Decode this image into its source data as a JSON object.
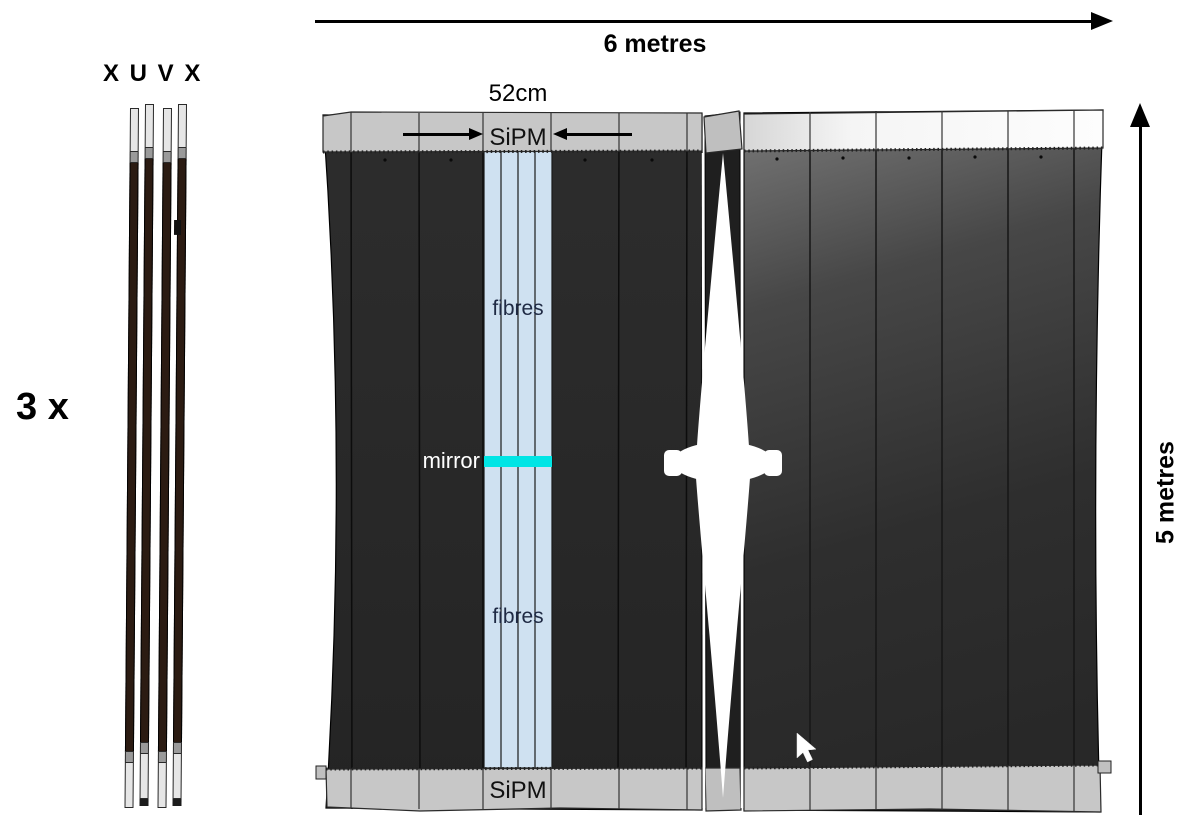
{
  "side_view": {
    "orientation_label": "X U V X",
    "count_label": "3 x"
  },
  "dimensions": {
    "width_label": "6 metres",
    "height_label": "5 metres",
    "module_width_label": "52cm"
  },
  "front_view": {
    "sipm_top_label": "SiPM",
    "sipm_bottom_label": "SiPM",
    "fibres_top_label": "fibres",
    "fibres_bottom_label": "fibres",
    "mirror_label": "mirror"
  },
  "colors": {
    "mirror_cyan": "#00e5e5",
    "fibre_column_blue": "#cfe1f1",
    "panel_dark": "#272727",
    "readout_band_gray": "#c7c7c7"
  }
}
